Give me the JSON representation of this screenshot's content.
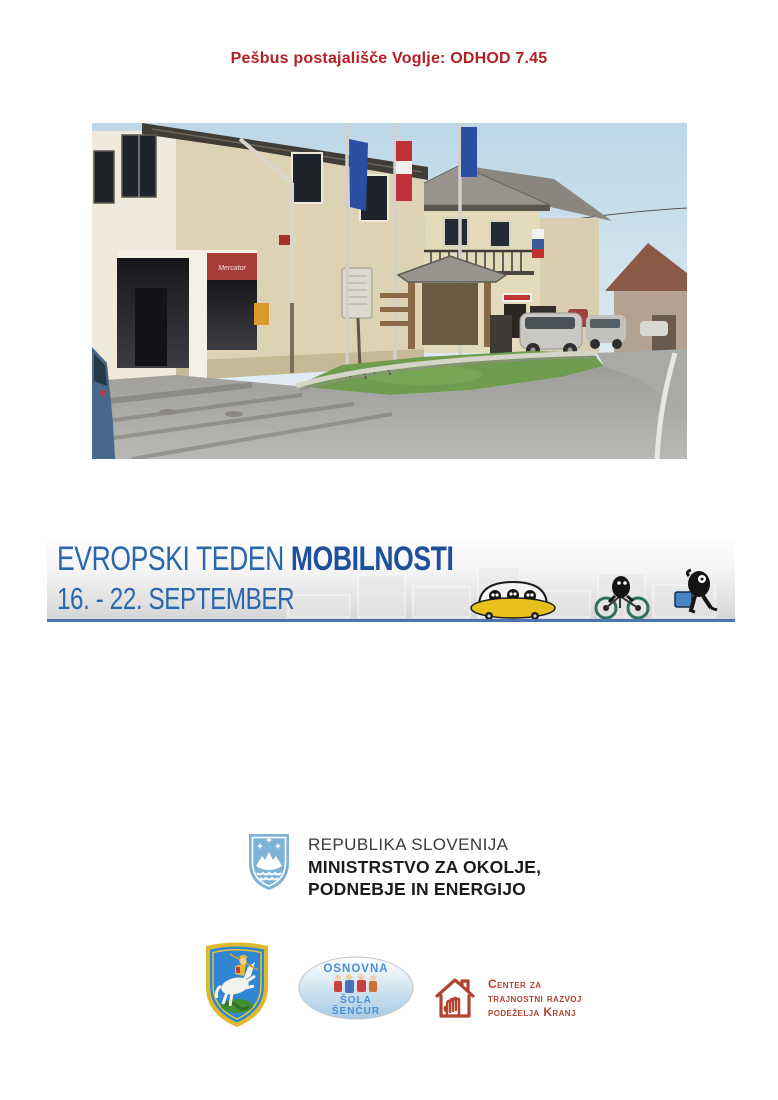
{
  "page_title": "Pešbus postajališče Voglje: ODHOD 7.45",
  "banner": {
    "title_light": "EVROPSKI TEDEN ",
    "title_bold": "MOBILNOSTI",
    "subtitle": "16. - 22. SEPTEMBER",
    "icons": [
      "dome-car-icon",
      "cyclist-icon",
      "pedestrian-icon"
    ]
  },
  "photo": {
    "shop_sign": "Mercator"
  },
  "ministry": {
    "line1": "REPUBLIKA SLOVENIJA",
    "line2": "MINISTRSTVO ZA OKOLJE,",
    "line3": "PODNEBJE IN ENERGIJO",
    "icon": "slovenia-coat-of-arms"
  },
  "partners": {
    "municipality_icon": "sencur-coat-of-arms",
    "school": {
      "line1": "OSNOVNA",
      "line2": "ŠOLA",
      "line3": "ŠENČUR"
    },
    "ctrp": {
      "icon": "house-hand-icon",
      "line1": "Center za",
      "line2": "trajnostni razvoj",
      "line3": "podeželja Kranj"
    }
  },
  "colors": {
    "title_red": "#b42025",
    "banner_blue": "#2a67ad",
    "banner_bold_blue": "#1d4f9e",
    "banner_rule_blue": "#4a74b4",
    "ctrp_red": "#b0452f",
    "school_blue": "#4a8fd2",
    "slovenia_blue": "#7cb3d6",
    "car_yellow": "#e8c01c"
  }
}
